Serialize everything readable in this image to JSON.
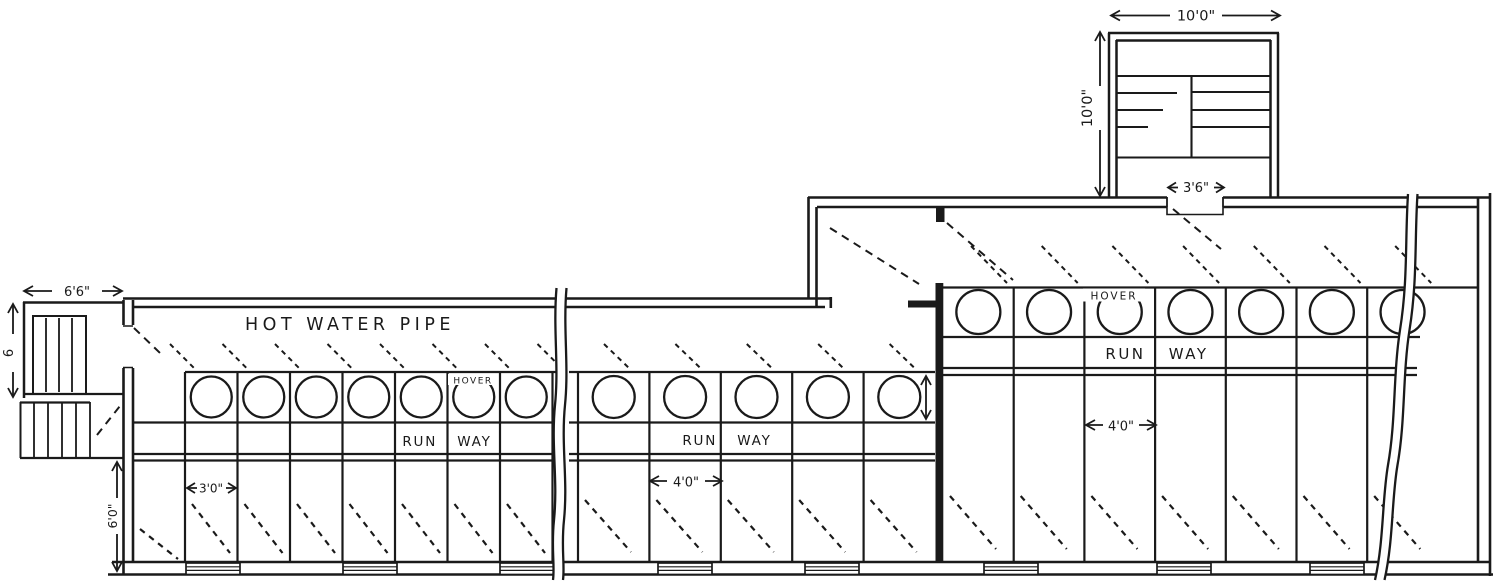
{
  "figure": {
    "type": "architectural floor plan",
    "subject": "Long brooder house heated by a hot water pipe, with hover brooders, runways and pens"
  },
  "colors": {
    "ink": "#1a1a1a",
    "paper": "#ffffff"
  },
  "labels": {
    "hot_water_pipe": "HOT WATER PIPE",
    "runway_left": "RUN WAY",
    "runway_middle": "RUN WAY",
    "runway_right": "RUN WAY",
    "hover_left": "HOVER",
    "hover_right": "HOVER"
  },
  "dimensions": {
    "feed_room_width": "10'0\"",
    "feed_room_depth": "10'0\"",
    "feed_room_door_width": "3'6\"",
    "left_annex_width": "6'6\"",
    "left_annex_depth": "6",
    "left_alley_depth": "6'0\"",
    "pen_width_left_section": "3'0\"",
    "pen_width_middle_section": "4'0\"",
    "pen_width_right_section": "4'0\""
  },
  "sections": {
    "left": {
      "hover_circles": 7,
      "pens": 7
    },
    "middle": {
      "hover_circles": 5,
      "pens": 5
    },
    "right": {
      "hover_circles": 7,
      "pens": 7
    }
  }
}
